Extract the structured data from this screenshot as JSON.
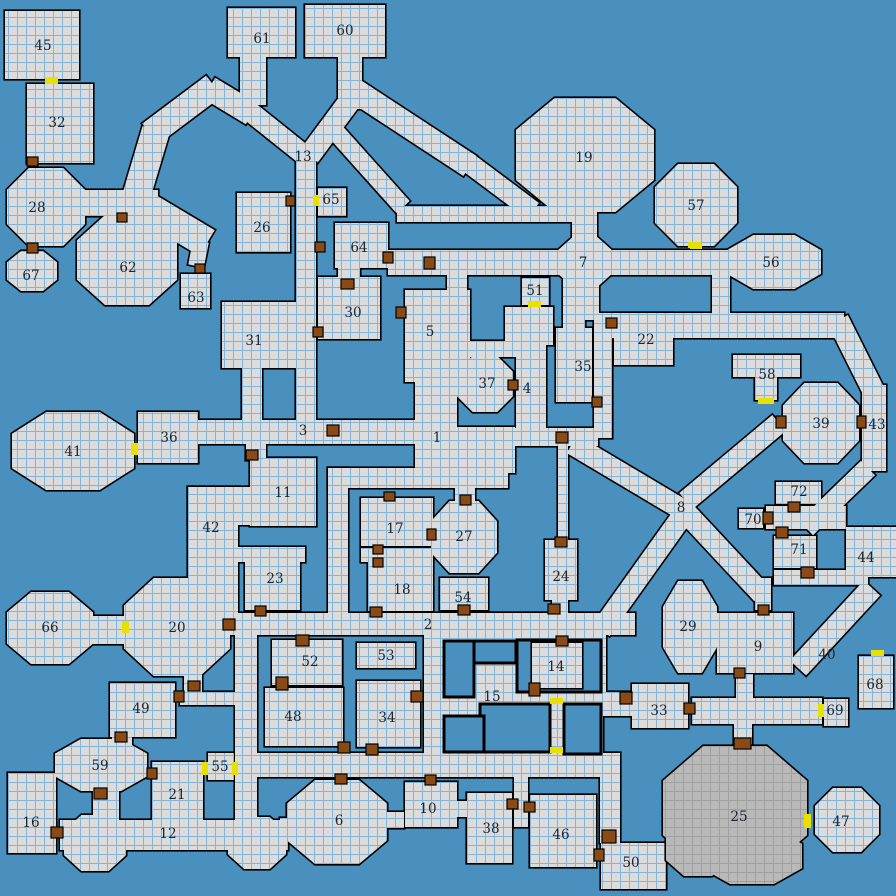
{
  "title": "Dungeon map",
  "colors": {
    "background": "#4a90be",
    "room_fill": "#dcdcdc",
    "grid_line": "#84b4d6",
    "wall": "#000000",
    "cave_fill": "#b9b9b9",
    "cave_grid": "#a0a0a0",
    "door_brown": "#8a4a15",
    "door_yellow": "#e8e000",
    "label_text": "#1b2430"
  },
  "grid": {
    "cell": 9
  },
  "map": {
    "rects": [
      [
        5,
        11,
        74,
        68
      ],
      [
        27,
        84,
        66,
        79
      ],
      [
        181,
        274,
        29,
        34
      ],
      [
        237,
        193,
        53,
        59
      ],
      [
        228,
        8,
        67,
        49
      ],
      [
        240,
        57,
        26,
        48
      ],
      [
        305,
        5,
        80,
        52
      ],
      [
        338,
        57,
        24,
        52
      ],
      [
        318,
        188,
        28,
        28
      ],
      [
        335,
        223,
        53,
        45
      ],
      [
        338,
        266,
        22,
        14
      ],
      [
        296,
        148,
        20,
        296
      ],
      [
        318,
        277,
        62,
        62
      ],
      [
        222,
        302,
        78,
        66
      ],
      [
        80,
        190,
        78,
        26
      ],
      [
        397,
        206,
        180,
        16
      ],
      [
        388,
        250,
        342,
        25
      ],
      [
        572,
        195,
        25,
        60
      ],
      [
        577,
        272,
        22,
        48
      ],
      [
        712,
        268,
        18,
        50
      ],
      [
        522,
        278,
        27,
        27
      ],
      [
        505,
        307,
        48,
        38
      ],
      [
        596,
        313,
        248,
        25
      ],
      [
        614,
        313,
        59,
        52
      ],
      [
        556,
        328,
        36,
        74
      ],
      [
        563,
        270,
        22,
        62
      ],
      [
        594,
        316,
        18,
        122
      ],
      [
        516,
        338,
        30,
        94
      ],
      [
        466,
        341,
        52,
        16
      ],
      [
        447,
        268,
        20,
        26
      ],
      [
        405,
        290,
        65,
        92
      ],
      [
        415,
        378,
        42,
        56
      ],
      [
        415,
        427,
        100,
        46
      ],
      [
        505,
        428,
        93,
        18
      ],
      [
        558,
        444,
        10,
        98
      ],
      [
        545,
        540,
        32,
        60
      ],
      [
        552,
        598,
        16,
        18
      ],
      [
        328,
        468,
        180,
        20
      ],
      [
        328,
        468,
        20,
        150
      ],
      [
        361,
        498,
        72,
        48
      ],
      [
        361,
        548,
        72,
        14
      ],
      [
        368,
        562,
        65,
        49
      ],
      [
        455,
        485,
        20,
        20
      ],
      [
        440,
        578,
        48,
        32
      ],
      [
        230,
        613,
        405,
        22
      ],
      [
        246,
        444,
        20,
        16
      ],
      [
        250,
        458,
        66,
        68
      ],
      [
        188,
        487,
        128,
        38
      ],
      [
        188,
        487,
        50,
        130
      ],
      [
        238,
        547,
        67,
        15
      ],
      [
        245,
        560,
        55,
        50
      ],
      [
        138,
        412,
        60,
        51
      ],
      [
        194,
        420,
        226,
        24
      ],
      [
        242,
        364,
        20,
        60
      ],
      [
        272,
        640,
        70,
        45
      ],
      [
        265,
        688,
        78,
        58
      ],
      [
        357,
        643,
        58,
        25
      ],
      [
        357,
        681,
        63,
        66
      ],
      [
        424,
        634,
        22,
        124
      ],
      [
        441,
        613,
        162,
        164
      ],
      [
        584,
        634,
        22,
        70
      ],
      [
        584,
        692,
        48,
        24
      ],
      [
        632,
        684,
        56,
        44
      ],
      [
        692,
        698,
        130,
        26
      ],
      [
        736,
        674,
        17,
        28
      ],
      [
        734,
        722,
        18,
        24
      ],
      [
        717,
        613,
        76,
        60
      ],
      [
        755,
        578,
        16,
        32
      ],
      [
        774,
        536,
        42,
        32
      ],
      [
        774,
        570,
        94,
        15
      ],
      [
        846,
        527,
        50,
        50
      ],
      [
        776,
        482,
        45,
        22
      ],
      [
        739,
        509,
        24,
        19
      ],
      [
        766,
        506,
        80,
        23
      ],
      [
        862,
        385,
        24,
        86
      ],
      [
        859,
        656,
        34,
        52
      ],
      [
        824,
        699,
        24,
        27
      ],
      [
        733,
        355,
        67,
        22
      ],
      [
        755,
        375,
        22,
        25
      ],
      [
        235,
        753,
        382,
        24
      ],
      [
        600,
        753,
        20,
        90
      ],
      [
        601,
        843,
        65,
        46
      ],
      [
        530,
        795,
        66,
        72
      ],
      [
        467,
        793,
        45,
        70
      ],
      [
        455,
        801,
        12,
        16
      ],
      [
        405,
        782,
        52,
        45
      ],
      [
        514,
        770,
        14,
        57
      ],
      [
        382,
        812,
        22,
        16
      ],
      [
        280,
        818,
        32,
        18
      ],
      [
        60,
        820,
        228,
        30
      ],
      [
        8,
        773,
        48,
        80
      ],
      [
        152,
        762,
        51,
        62
      ],
      [
        208,
        753,
        26,
        27
      ],
      [
        235,
        634,
        22,
        190
      ],
      [
        180,
        692,
        58,
        13
      ],
      [
        184,
        670,
        18,
        24
      ],
      [
        110,
        683,
        65,
        54
      ],
      [
        112,
        735,
        20,
        14
      ],
      [
        93,
        788,
        26,
        34
      ],
      [
        88,
        616,
        40,
        28
      ]
    ],
    "blobs": [
      [
        46,
        207,
        39,
        39
      ],
      [
        32,
        271,
        25,
        20
      ],
      [
        127,
        260,
        50,
        45
      ],
      [
        585,
        155,
        69,
        57
      ],
      [
        696,
        205,
        41,
        41
      ],
      [
        774,
        262,
        47,
        27
      ],
      [
        585,
        262,
        28,
        25
      ],
      [
        73,
        451,
        61,
        39
      ],
      [
        821,
        423,
        38,
        40
      ],
      [
        485,
        384,
        28,
        28
      ],
      [
        464,
        537,
        33,
        36
      ],
      [
        50,
        628,
        43,
        36
      ],
      [
        177,
        627,
        53,
        49
      ],
      [
        101,
        765,
        46,
        26
      ],
      [
        337,
        822,
        50,
        42
      ],
      [
        690,
        627,
        27,
        46
      ],
      [
        95,
        843,
        31,
        28
      ],
      [
        257,
        843,
        29,
        26
      ],
      [
        847,
        820,
        32,
        32
      ]
    ],
    "diags": [
      [
        128,
        224,
        156,
        130,
        28
      ],
      [
        150,
        134,
        214,
        86,
        26
      ],
      [
        209,
        88,
        252,
        114,
        24
      ],
      [
        243,
        106,
        303,
        154,
        20
      ],
      [
        349,
        102,
        309,
        156,
        22
      ],
      [
        354,
        90,
        470,
        166,
        24
      ],
      [
        466,
        161,
        533,
        211,
        20
      ],
      [
        334,
        130,
        403,
        207,
        18
      ],
      [
        140,
        203,
        207,
        243,
        30
      ],
      [
        201,
        241,
        196,
        266,
        16
      ],
      [
        572,
        444,
        688,
        513,
        21
      ],
      [
        686,
        501,
        779,
        423,
        21
      ],
      [
        688,
        508,
        601,
        630,
        21
      ],
      [
        678,
        504,
        762,
        594,
        21
      ],
      [
        838,
        320,
        874,
        392,
        22
      ],
      [
        868,
        468,
        806,
        528,
        20
      ],
      [
        798,
        668,
        872,
        588,
        22
      ]
    ],
    "voids": [
      [
        444,
        641,
        72,
        22
      ],
      [
        444,
        641,
        30,
        56
      ],
      [
        517,
        640,
        84,
        52
      ],
      [
        480,
        704,
        70,
        48
      ],
      [
        444,
        716,
        40,
        36
      ],
      [
        564,
        704,
        37,
        50
      ]
    ],
    "over_rects": [
      [
        532,
        643,
        50,
        45
      ]
    ],
    "cave_blobs": [
      [
        735,
        808,
        72,
        62
      ],
      [
        752,
        856,
        50,
        28
      ],
      [
        698,
        848,
        32,
        28
      ]
    ],
    "doors": [
      [
        45,
        77,
        13,
        7,
        "y"
      ],
      [
        27,
        157,
        11,
        9,
        "b"
      ],
      [
        27,
        243,
        11,
        10,
        "b"
      ],
      [
        117,
        213,
        10,
        9,
        "b"
      ],
      [
        195,
        264,
        10,
        9,
        "b"
      ],
      [
        286,
        196,
        9,
        10,
        "b"
      ],
      [
        313,
        195,
        6,
        11,
        "y"
      ],
      [
        315,
        242,
        10,
        10,
        "b"
      ],
      [
        341,
        279,
        13,
        10,
        "b"
      ],
      [
        383,
        252,
        10,
        11,
        "b"
      ],
      [
        424,
        257,
        11,
        12,
        "b"
      ],
      [
        528,
        301,
        13,
        6,
        "y"
      ],
      [
        688,
        242,
        13,
        6,
        "y"
      ],
      [
        606,
        318,
        11,
        10,
        "b"
      ],
      [
        592,
        397,
        10,
        10,
        "b"
      ],
      [
        508,
        380,
        10,
        10,
        "b"
      ],
      [
        556,
        432,
        12,
        11,
        "b"
      ],
      [
        555,
        537,
        12,
        10,
        "b"
      ],
      [
        548,
        604,
        12,
        10,
        "b"
      ],
      [
        313,
        327,
        10,
        10,
        "b"
      ],
      [
        396,
        307,
        10,
        11,
        "b"
      ],
      [
        327,
        425,
        12,
        11,
        "b"
      ],
      [
        246,
        450,
        12,
        10,
        "b"
      ],
      [
        131,
        443,
        7,
        12,
        "y"
      ],
      [
        758,
        398,
        16,
        6,
        "y"
      ],
      [
        776,
        416,
        10,
        12,
        "b"
      ],
      [
        857,
        416,
        9,
        12,
        "b"
      ],
      [
        788,
        502,
        12,
        10,
        "b"
      ],
      [
        763,
        512,
        10,
        12,
        "b"
      ],
      [
        776,
        527,
        12,
        11,
        "b"
      ],
      [
        801,
        567,
        13,
        11,
        "b"
      ],
      [
        871,
        650,
        13,
        6,
        "y"
      ],
      [
        818,
        704,
        6,
        13,
        "y"
      ],
      [
        684,
        703,
        11,
        11,
        "b"
      ],
      [
        620,
        692,
        12,
        12,
        "b"
      ],
      [
        734,
        738,
        17,
        11,
        "b"
      ],
      [
        804,
        814,
        7,
        14,
        "y"
      ],
      [
        602,
        830,
        14,
        13,
        "b"
      ],
      [
        594,
        849,
        10,
        12,
        "b"
      ],
      [
        524,
        802,
        11,
        10,
        "b"
      ],
      [
        507,
        799,
        11,
        10,
        "b"
      ],
      [
        425,
        775,
        11,
        10,
        "b"
      ],
      [
        335,
        774,
        12,
        10,
        "b"
      ],
      [
        51,
        827,
        12,
        11,
        "b"
      ],
      [
        94,
        788,
        13,
        11,
        "b"
      ],
      [
        147,
        768,
        10,
        11,
        "b"
      ],
      [
        202,
        762,
        6,
        13,
        "y"
      ],
      [
        232,
        762,
        6,
        13,
        "y"
      ],
      [
        115,
        732,
        12,
        10,
        "b"
      ],
      [
        174,
        691,
        10,
        11,
        "b"
      ],
      [
        188,
        681,
        12,
        10,
        "b"
      ],
      [
        223,
        619,
        12,
        11,
        "b"
      ],
      [
        255,
        606,
        11,
        10,
        "b"
      ],
      [
        296,
        635,
        13,
        11,
        "b"
      ],
      [
        276,
        677,
        12,
        13,
        "b"
      ],
      [
        370,
        607,
        12,
        10,
        "b"
      ],
      [
        458,
        605,
        12,
        10,
        "b"
      ],
      [
        556,
        636,
        12,
        10,
        "b"
      ],
      [
        529,
        683,
        11,
        13,
        "b"
      ],
      [
        550,
        698,
        13,
        6,
        "y"
      ],
      [
        550,
        747,
        13,
        6,
        "y"
      ],
      [
        384,
        492,
        11,
        9,
        "b"
      ],
      [
        460,
        495,
        11,
        10,
        "b"
      ],
      [
        427,
        529,
        9,
        11,
        "b"
      ],
      [
        373,
        545,
        10,
        9,
        "b"
      ],
      [
        373,
        558,
        10,
        9,
        "b"
      ],
      [
        366,
        744,
        12,
        11,
        "b"
      ],
      [
        338,
        742,
        12,
        11,
        "b"
      ],
      [
        411,
        691,
        12,
        11,
        "b"
      ],
      [
        122,
        621,
        7,
        12,
        "y"
      ],
      [
        758,
        605,
        11,
        10,
        "b"
      ],
      [
        734,
        668,
        11,
        10,
        "b"
      ],
      [
        690,
        244,
        12,
        5,
        "y"
      ]
    ],
    "labels": [
      [
        1,
        437,
        437
      ],
      [
        2,
        428,
        624
      ],
      [
        3,
        303,
        430
      ],
      [
        4,
        527,
        388
      ],
      [
        5,
        430,
        331
      ],
      [
        6,
        339,
        820
      ],
      [
        7,
        583,
        262
      ],
      [
        8,
        681,
        507
      ],
      [
        9,
        758,
        646
      ],
      [
        10,
        428,
        808
      ],
      [
        11,
        283,
        492
      ],
      [
        12,
        168,
        833
      ],
      [
        13,
        303,
        156
      ],
      [
        14,
        556,
        666
      ],
      [
        15,
        492,
        696
      ],
      [
        16,
        31,
        822
      ],
      [
        17,
        395,
        528
      ],
      [
        18,
        402,
        589
      ],
      [
        19,
        584,
        157
      ],
      [
        20,
        177,
        627
      ],
      [
        21,
        177,
        794
      ],
      [
        22,
        646,
        339
      ],
      [
        23,
        275,
        578
      ],
      [
        24,
        561,
        576
      ],
      [
        25,
        739,
        816
      ],
      [
        26,
        262,
        227
      ],
      [
        27,
        464,
        536
      ],
      [
        28,
        37,
        207
      ],
      [
        29,
        688,
        626
      ],
      [
        30,
        353,
        312
      ],
      [
        31,
        254,
        340
      ],
      [
        32,
        57,
        122
      ],
      [
        33,
        659,
        710
      ],
      [
        34,
        387,
        717
      ],
      [
        35,
        583,
        366
      ],
      [
        36,
        169,
        437
      ],
      [
        37,
        487,
        383
      ],
      [
        38,
        491,
        828
      ],
      [
        39,
        821,
        423
      ],
      [
        40,
        827,
        654
      ],
      [
        41,
        73,
        451
      ],
      [
        42,
        211,
        527
      ],
      [
        43,
        877,
        424
      ],
      [
        44,
        866,
        557
      ],
      [
        45,
        43,
        45
      ],
      [
        46,
        561,
        834
      ],
      [
        47,
        841,
        821
      ],
      [
        48,
        293,
        716
      ],
      [
        49,
        141,
        708
      ],
      [
        50,
        631,
        862
      ],
      [
        51,
        535,
        290
      ],
      [
        52,
        310,
        661
      ],
      [
        53,
        386,
        655
      ],
      [
        54,
        463,
        597
      ],
      [
        55,
        220,
        766
      ],
      [
        56,
        771,
        262
      ],
      [
        57,
        696,
        205
      ],
      [
        58,
        767,
        374
      ],
      [
        59,
        100,
        765
      ],
      [
        60,
        345,
        30
      ],
      [
        61,
        262,
        38
      ],
      [
        62,
        128,
        267
      ],
      [
        63,
        196,
        297
      ],
      [
        64,
        359,
        247
      ],
      [
        65,
        331,
        199
      ],
      [
        66,
        50,
        627
      ],
      [
        67,
        31,
        275
      ],
      [
        68,
        875,
        684
      ],
      [
        69,
        835,
        710
      ],
      [
        70,
        753,
        519
      ],
      [
        71,
        799,
        549
      ],
      [
        72,
        799,
        491
      ]
    ]
  }
}
